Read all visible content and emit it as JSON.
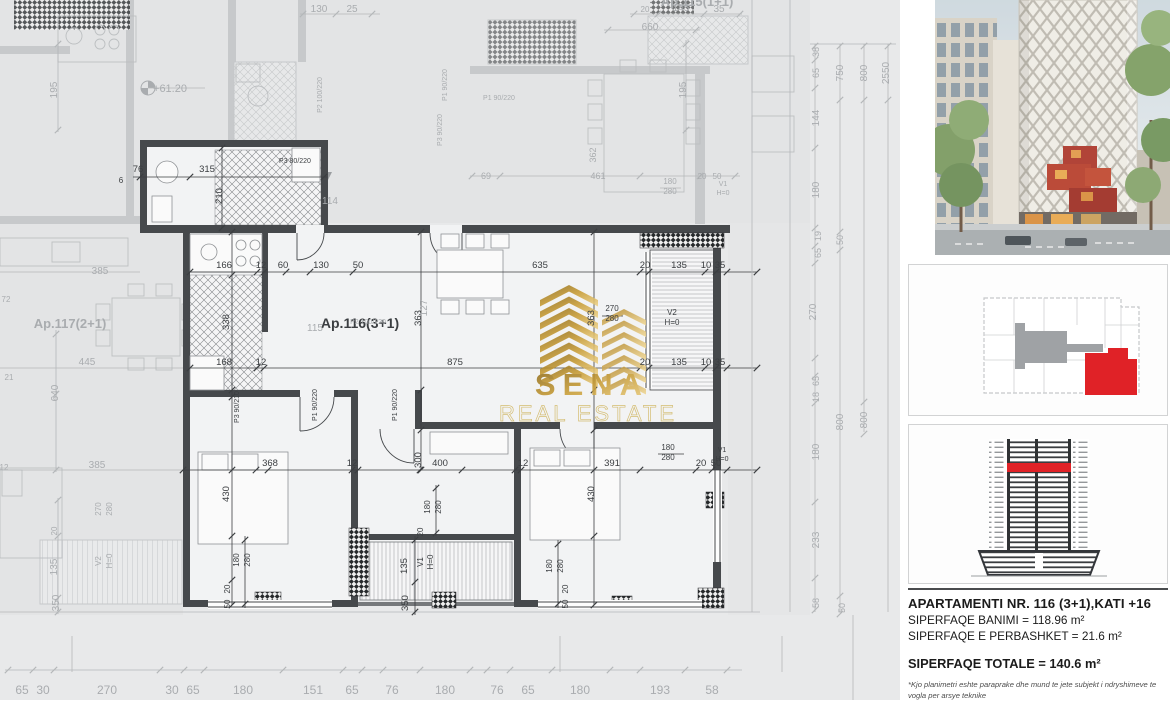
{
  "watermark": {
    "name": "SENA",
    "tagline": "REAL ESTATE",
    "gold": "#c79b33"
  },
  "sidebar": {
    "accent_red": "#e02227",
    "core_gray": "#9fa2a5",
    "info": {
      "title": "APARTAMENTI NR. 116 (3+1),KATI +16",
      "line1": "SIPERFAQE BANIMI = 118.96 m²",
      "line2": "SIPERFAQE E PERBASHKET = 21.6 m²",
      "total": "SIPERFAQE TOTALE = 140.6 m²",
      "footnote": "*Kjo planimetri eshte paraprake dhe mund te jete subjekt i ndryshimeve te vogla per arsye teknike"
    }
  },
  "plan": {
    "active_unit": "Ap.116(3+1)",
    "neighbor_left": "Ap.117(2+1)",
    "neighbor_top": "Ap.115(1+1)",
    "level_marker": "+61.20",
    "labels": [
      {
        "x": 224,
        "y": 268,
        "t": "166"
      },
      {
        "x": 261,
        "y": 268,
        "t": "12"
      },
      {
        "x": 283,
        "y": 268,
        "t": "60"
      },
      {
        "x": 321,
        "y": 268,
        "t": "130"
      },
      {
        "x": 358,
        "y": 268,
        "t": "50"
      },
      {
        "x": 540,
        "y": 268,
        "t": "635"
      },
      {
        "x": 645,
        "y": 268,
        "t": "20"
      },
      {
        "x": 679,
        "y": 268,
        "t": "135"
      },
      {
        "x": 706,
        "y": 268,
        "t": "10"
      },
      {
        "x": 720,
        "y": 268,
        "t": "35"
      },
      {
        "x": 224,
        "y": 365,
        "t": "168"
      },
      {
        "x": 261,
        "y": 365,
        "t": "12"
      },
      {
        "x": 455,
        "y": 365,
        "t": "875"
      },
      {
        "x": 645,
        "y": 365,
        "t": "20"
      },
      {
        "x": 679,
        "y": 365,
        "t": "135"
      },
      {
        "x": 706,
        "y": 365,
        "t": "10"
      },
      {
        "x": 720,
        "y": 365,
        "t": "35"
      },
      {
        "x": 270,
        "y": 466,
        "t": "368"
      },
      {
        "x": 352,
        "y": 466,
        "t": "12"
      },
      {
        "x": 440,
        "y": 466,
        "t": "400"
      },
      {
        "x": 523,
        "y": 466,
        "t": "12"
      },
      {
        "x": 612,
        "y": 466,
        "t": "391"
      },
      {
        "x": 701,
        "y": 466,
        "t": "20"
      },
      {
        "x": 716,
        "y": 466,
        "t": "50"
      },
      {
        "x": 229,
        "y": 322,
        "t": "338",
        "r": 1
      },
      {
        "x": 421,
        "y": 318,
        "t": "363",
        "r": 1
      },
      {
        "x": 594,
        "y": 318,
        "t": "363",
        "r": 1
      },
      {
        "x": 229,
        "y": 494,
        "t": "430",
        "r": 1
      },
      {
        "x": 594,
        "y": 494,
        "t": "430",
        "r": 1
      },
      {
        "x": 421,
        "y": 460,
        "t": "300",
        "r": 1
      },
      {
        "x": 222,
        "y": 196,
        "t": "210",
        "r": 1
      },
      {
        "x": 207,
        "y": 172,
        "t": "315"
      },
      {
        "x": 138,
        "y": 172,
        "t": "76"
      },
      {
        "x": 121,
        "y": 183,
        "t": "6",
        "s": 8
      },
      {
        "x": 295,
        "y": 163,
        "t": "P3 80/220",
        "s": 7
      },
      {
        "x": 612,
        "y": 311,
        "t": "270",
        "s": 8
      },
      {
        "x": 612,
        "y": 321,
        "t": "280",
        "s": 8
      },
      {
        "x": 672,
        "y": 315,
        "t": "V2",
        "s": 8
      },
      {
        "x": 672,
        "y": 325,
        "t": "H=0",
        "s": 8
      },
      {
        "x": 317,
        "y": 405,
        "t": "P1 90/220",
        "r": 1,
        "s": 7
      },
      {
        "x": 397,
        "y": 405,
        "t": "P1 90/220",
        "r": 1,
        "s": 7
      },
      {
        "x": 239,
        "y": 407,
        "t": "P3 90/210",
        "r": 1,
        "s": 7
      },
      {
        "x": 239,
        "y": 560,
        "t": "180",
        "r": 1,
        "s": 8
      },
      {
        "x": 250,
        "y": 560,
        "t": "280",
        "r": 1,
        "s": 8
      },
      {
        "x": 430,
        "y": 507,
        "t": "180",
        "r": 1,
        "s": 8
      },
      {
        "x": 441,
        "y": 507,
        "t": "280",
        "r": 1,
        "s": 8
      },
      {
        "x": 552,
        "y": 566,
        "t": "180",
        "r": 1,
        "s": 8
      },
      {
        "x": 563,
        "y": 566,
        "t": "280",
        "r": 1,
        "s": 8
      },
      {
        "x": 668,
        "y": 450,
        "t": "180",
        "s": 8
      },
      {
        "x": 668,
        "y": 460,
        "t": "280",
        "s": 8
      },
      {
        "x": 722,
        "y": 452,
        "t": "V1",
        "s": 7
      },
      {
        "x": 722,
        "y": 461,
        "t": "H=0",
        "s": 7
      },
      {
        "x": 407,
        "y": 566,
        "t": "135",
        "r": 1
      },
      {
        "x": 423,
        "y": 562,
        "t": "V1",
        "r": 1,
        "s": 8
      },
      {
        "x": 433,
        "y": 562,
        "t": "H=0",
        "r": 1,
        "s": 8
      },
      {
        "x": 408,
        "y": 603,
        "t": "350",
        "r": 1
      },
      {
        "x": 230,
        "y": 589,
        "t": "20",
        "r": 1,
        "s": 8
      },
      {
        "x": 230,
        "y": 604,
        "t": "50",
        "r": 1,
        "s": 8
      },
      {
        "x": 568,
        "y": 589,
        "t": "20",
        "r": 1,
        "s": 8
      },
      {
        "x": 568,
        "y": 604,
        "t": "50",
        "r": 1,
        "s": 8
      },
      {
        "x": 423,
        "y": 532,
        "t": "20",
        "r": 1,
        "s": 8
      },
      {
        "x": 360,
        "y": 328,
        "t": "Ap.116(3+1)",
        "s": 14,
        "b": 1
      },
      {
        "x": 70,
        "y": 328,
        "t": "Ap.117(2+1)",
        "s": 13,
        "b": 1,
        "c": "f"
      },
      {
        "x": 697,
        "y": 6,
        "t": "Ap.115(1+1)",
        "s": 13,
        "b": 1,
        "c": "f"
      },
      {
        "x": 650,
        "y": 30,
        "t": "660",
        "s": 10,
        "c": "f"
      },
      {
        "x": 645,
        "y": 12,
        "t": "20",
        "s": 8,
        "c": "f"
      },
      {
        "x": 681,
        "y": 11,
        "t": "145",
        "s": 10,
        "c": "f"
      },
      {
        "x": 719,
        "y": 12,
        "t": "35",
        "s": 10,
        "c": "f"
      },
      {
        "x": 319,
        "y": 12,
        "t": "130",
        "s": 10,
        "c": "f"
      },
      {
        "x": 352,
        "y": 12,
        "t": "25",
        "s": 10,
        "c": "f"
      },
      {
        "x": 57,
        "y": 90,
        "t": "195",
        "r": 1,
        "s": 10,
        "c": "f"
      },
      {
        "x": 686,
        "y": 90,
        "t": "195",
        "r": 1,
        "s": 10,
        "c": "f"
      },
      {
        "x": 170,
        "y": 92,
        "t": "+61.20",
        "s": 11,
        "c": "f"
      },
      {
        "x": 322,
        "y": 95,
        "t": "P2 100/220",
        "r": 1,
        "s": 7,
        "c": "f"
      },
      {
        "x": 330,
        "y": 204,
        "t": "114",
        "s": 10,
        "c": "f"
      },
      {
        "x": 315,
        "y": 331,
        "t": "115",
        "s": 10,
        "c": "f"
      },
      {
        "x": 368,
        "y": 324,
        "t": "P2 100/220",
        "s": 7,
        "c": "f"
      },
      {
        "x": 427,
        "y": 308,
        "t": "127",
        "r": 1,
        "s": 10,
        "c": "f"
      },
      {
        "x": 447,
        "y": 85,
        "t": "P1 90/220",
        "r": 1,
        "s": 7,
        "c": "f"
      },
      {
        "x": 499,
        "y": 100,
        "t": "P1 90/220",
        "s": 7,
        "c": "f"
      },
      {
        "x": 442,
        "y": 130,
        "t": "P3 90/220",
        "r": 1,
        "s": 7,
        "c": "f"
      },
      {
        "x": 486,
        "y": 179,
        "t": "69",
        "s": 9,
        "c": "f"
      },
      {
        "x": 598,
        "y": 179,
        "t": "461",
        "s": 9,
        "c": "f"
      },
      {
        "x": 596,
        "y": 155,
        "t": "362",
        "r": 1,
        "s": 9,
        "c": "f"
      },
      {
        "x": 670,
        "y": 184,
        "t": "180",
        "s": 8,
        "c": "f"
      },
      {
        "x": 670,
        "y": 194,
        "t": "280",
        "s": 8,
        "c": "f"
      },
      {
        "x": 702,
        "y": 179,
        "t": "20",
        "s": 8,
        "c": "f"
      },
      {
        "x": 717,
        "y": 179,
        "t": "50",
        "s": 8,
        "c": "f"
      },
      {
        "x": 723,
        "y": 186,
        "t": "V1",
        "s": 7,
        "c": "f"
      },
      {
        "x": 723,
        "y": 195,
        "t": "H=0",
        "s": 7,
        "c": "f"
      },
      {
        "x": 100,
        "y": 274,
        "t": "385",
        "s": 10,
        "c": "f"
      },
      {
        "x": 87,
        "y": 365,
        "t": "445",
        "s": 10,
        "c": "f"
      },
      {
        "x": 58,
        "y": 393,
        "t": "640",
        "r": 1,
        "s": 10,
        "c": "f"
      },
      {
        "x": 97,
        "y": 468,
        "t": "385",
        "s": 10,
        "c": "f"
      },
      {
        "x": 101,
        "y": 509,
        "t": "270",
        "r": 1,
        "s": 8,
        "c": "f"
      },
      {
        "x": 112,
        "y": 509,
        "t": "280",
        "r": 1,
        "s": 8,
        "c": "f"
      },
      {
        "x": 101,
        "y": 561,
        "t": "V2",
        "r": 1,
        "s": 8,
        "c": "f"
      },
      {
        "x": 112,
        "y": 561,
        "t": "H=0",
        "r": 1,
        "s": 8,
        "c": "f"
      },
      {
        "x": 57,
        "y": 567,
        "t": "135",
        "r": 1,
        "s": 10,
        "c": "f"
      },
      {
        "x": 59,
        "y": 603,
        "t": "350",
        "r": 1,
        "s": 10,
        "c": "f"
      },
      {
        "x": 57,
        "y": 531,
        "t": "20",
        "r": 1,
        "s": 8,
        "c": "f"
      },
      {
        "x": 4,
        "y": 470,
        "t": "12",
        "s": 8,
        "c": "f"
      },
      {
        "x": 6,
        "y": 302,
        "t": "72",
        "s": 8,
        "c": "f"
      },
      {
        "x": 9,
        "y": 380,
        "t": "21",
        "s": 8,
        "c": "f"
      },
      {
        "x": 819,
        "y": 52,
        "t": "38",
        "r": 1,
        "s": 9,
        "c": "f"
      },
      {
        "x": 819,
        "y": 73,
        "t": "65",
        "r": 1,
        "s": 9,
        "c": "f"
      },
      {
        "x": 819,
        "y": 118,
        "t": "144",
        "r": 1,
        "s": 10,
        "c": "f"
      },
      {
        "x": 819,
        "y": 190,
        "t": "180",
        "r": 1,
        "s": 10,
        "c": "f"
      },
      {
        "x": 821,
        "y": 236,
        "t": "19",
        "r": 1,
        "s": 9,
        "c": "f"
      },
      {
        "x": 821,
        "y": 253,
        "t": "65",
        "r": 1,
        "s": 9,
        "c": "f"
      },
      {
        "x": 816,
        "y": 312,
        "t": "270",
        "r": 1,
        "s": 10,
        "c": "f"
      },
      {
        "x": 819,
        "y": 381,
        "t": "65",
        "r": 1,
        "s": 9,
        "c": "f"
      },
      {
        "x": 819,
        "y": 397,
        "t": "18",
        "r": 1,
        "s": 9,
        "c": "f"
      },
      {
        "x": 819,
        "y": 452,
        "t": "180",
        "r": 1,
        "s": 10,
        "c": "f"
      },
      {
        "x": 819,
        "y": 540,
        "t": "233",
        "r": 1,
        "s": 10,
        "c": "f"
      },
      {
        "x": 819,
        "y": 603,
        "t": "58",
        "r": 1,
        "s": 9,
        "c": "f"
      },
      {
        "x": 843,
        "y": 73,
        "t": "750",
        "r": 1,
        "s": 10,
        "c": "f"
      },
      {
        "x": 843,
        "y": 240,
        "t": "50",
        "r": 1,
        "s": 9,
        "c": "f"
      },
      {
        "x": 843,
        "y": 422,
        "t": "800",
        "r": 1,
        "s": 10,
        "c": "f"
      },
      {
        "x": 845,
        "y": 608,
        "t": "50",
        "r": 1,
        "s": 9,
        "c": "f"
      },
      {
        "x": 867,
        "y": 73,
        "t": "800",
        "r": 1,
        "s": 10,
        "c": "f"
      },
      {
        "x": 867,
        "y": 420,
        "t": "800",
        "r": 1,
        "s": 10,
        "c": "f"
      },
      {
        "x": 889,
        "y": 73,
        "t": "2550",
        "r": 1,
        "s": 10,
        "c": "f"
      },
      {
        "x": 22,
        "y": 694,
        "t": "65",
        "s": 12,
        "c": "f"
      },
      {
        "x": 43,
        "y": 694,
        "t": "30",
        "s": 12,
        "c": "f"
      },
      {
        "x": 107,
        "y": 694,
        "t": "270",
        "s": 12,
        "c": "f"
      },
      {
        "x": 172,
        "y": 694,
        "t": "30",
        "s": 12,
        "c": "f"
      },
      {
        "x": 193,
        "y": 694,
        "t": "65",
        "s": 12,
        "c": "f"
      },
      {
        "x": 243,
        "y": 694,
        "t": "180",
        "s": 12,
        "c": "f"
      },
      {
        "x": 313,
        "y": 694,
        "t": "151",
        "s": 12,
        "c": "f"
      },
      {
        "x": 352,
        "y": 694,
        "t": "65",
        "s": 12,
        "c": "f"
      },
      {
        "x": 392,
        "y": 694,
        "t": "76",
        "s": 12,
        "c": "f"
      },
      {
        "x": 445,
        "y": 694,
        "t": "180",
        "s": 12,
        "c": "f"
      },
      {
        "x": 497,
        "y": 694,
        "t": "76",
        "s": 12,
        "c": "f"
      },
      {
        "x": 528,
        "y": 694,
        "t": "65",
        "s": 12,
        "c": "f"
      },
      {
        "x": 580,
        "y": 694,
        "t": "180",
        "s": 12,
        "c": "f"
      },
      {
        "x": 660,
        "y": 694,
        "t": "193",
        "s": 12,
        "c": "f"
      },
      {
        "x": 712,
        "y": 694,
        "t": "58",
        "s": 12,
        "c": "f"
      }
    ]
  }
}
